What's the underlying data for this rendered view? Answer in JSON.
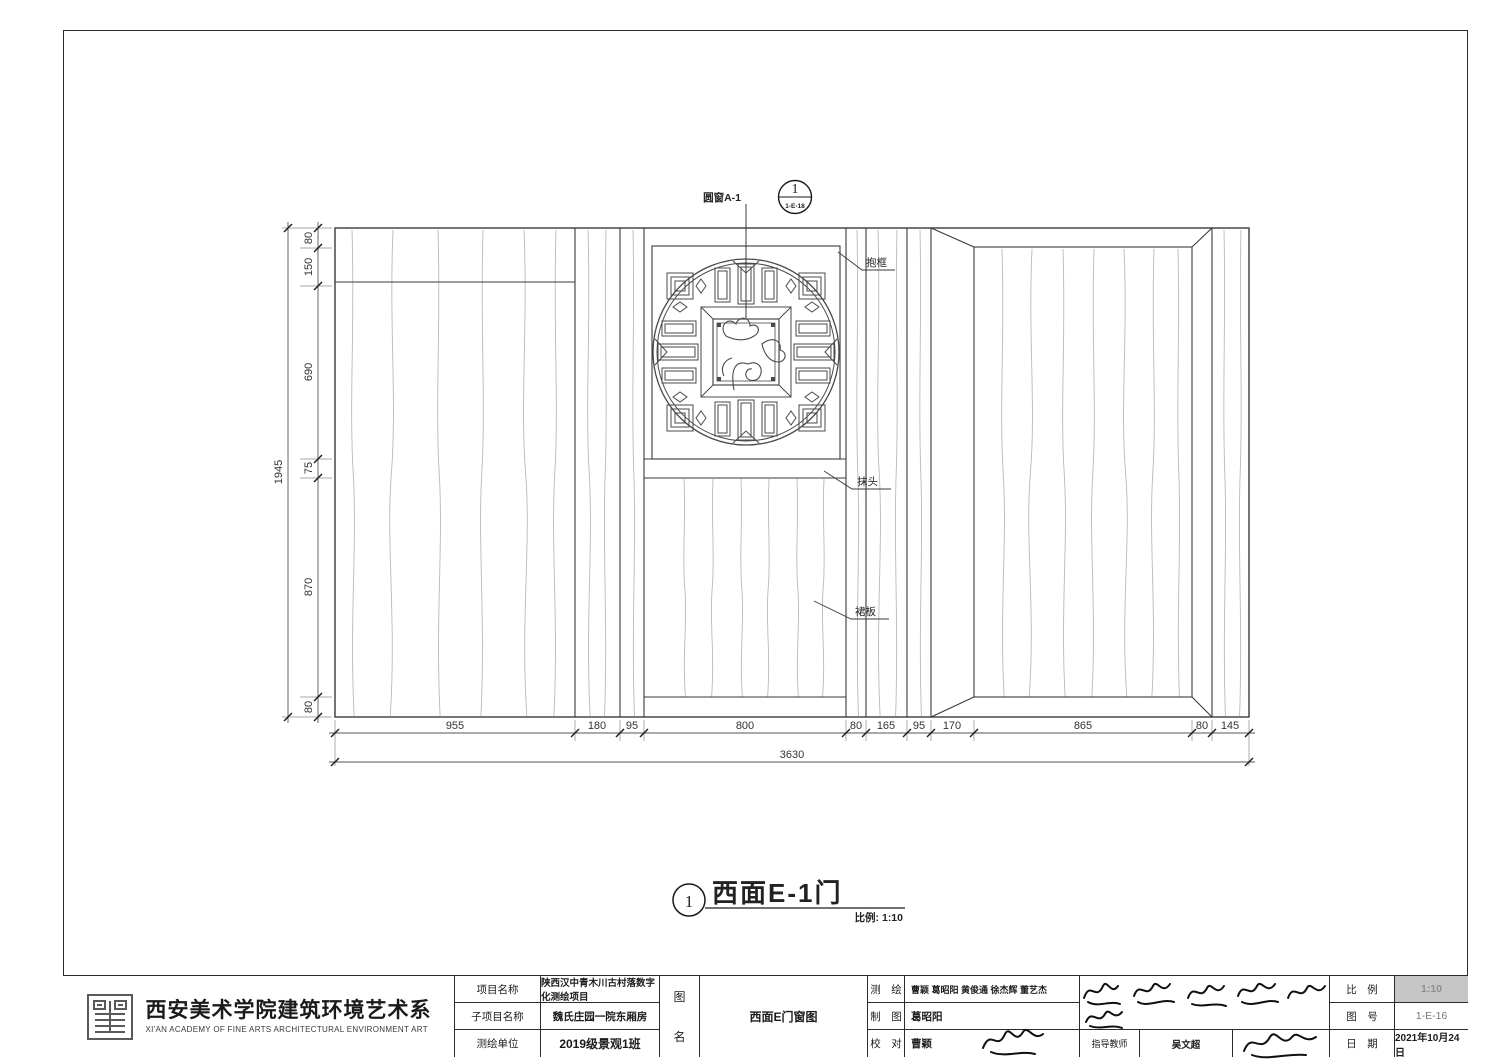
{
  "drawing": {
    "callout": {
      "label": "圆窗A-1",
      "number": "1",
      "ref": "1-E-18"
    },
    "labels": {
      "baokuang": "抱框",
      "motou": "抹头",
      "qunban": "裙板"
    },
    "dims": {
      "bottom": [
        "955",
        "180",
        "95",
        "800",
        "80",
        "165",
        "95",
        "170",
        "865",
        "80",
        "145"
      ],
      "bottom_total": "3630",
      "left": [
        "80",
        "150",
        "690",
        "75",
        "870",
        "80"
      ],
      "left_total": "1945"
    },
    "title": {
      "number": "1",
      "text": "西面E-1门",
      "scale_note": "比例: 1:10"
    }
  },
  "titleblock": {
    "org_cn": "西安美术学院建筑环境艺术系",
    "org_en": "XI'AN ACADEMY OF FINE ARTS ARCHITECTURAL ENVIRONMENT ART",
    "rows": {
      "project_label": "项目名称",
      "project_value": "陕西汉中青木川古村落数字化测绘项目",
      "subproject_label": "子项目名称",
      "subproject_value": "魏氏庄园一院东厢房",
      "unit_label": "测绘单位",
      "unit_value": "2019级景观1班"
    },
    "fig": {
      "label_char1": "图",
      "label_char2": "名",
      "name": "西面E门窗图"
    },
    "crew": {
      "survey_label": "测　绘",
      "survey_value": "曹颖  葛昭阳  黄俊通  徐杰辉  董艺杰",
      "draft_label": "制　图",
      "draft_value": "葛昭阳",
      "check_label": "校　对",
      "check_value": "曹颖",
      "advisor_label": "指导教师",
      "advisor_value": "吴文超"
    },
    "meta": {
      "scale_label": "比　例",
      "scale_value": "1:10",
      "figno_label": "图　号",
      "figno_value": "1-E-16",
      "date_label": "日　期",
      "date_value": "2021年10月24日"
    }
  }
}
